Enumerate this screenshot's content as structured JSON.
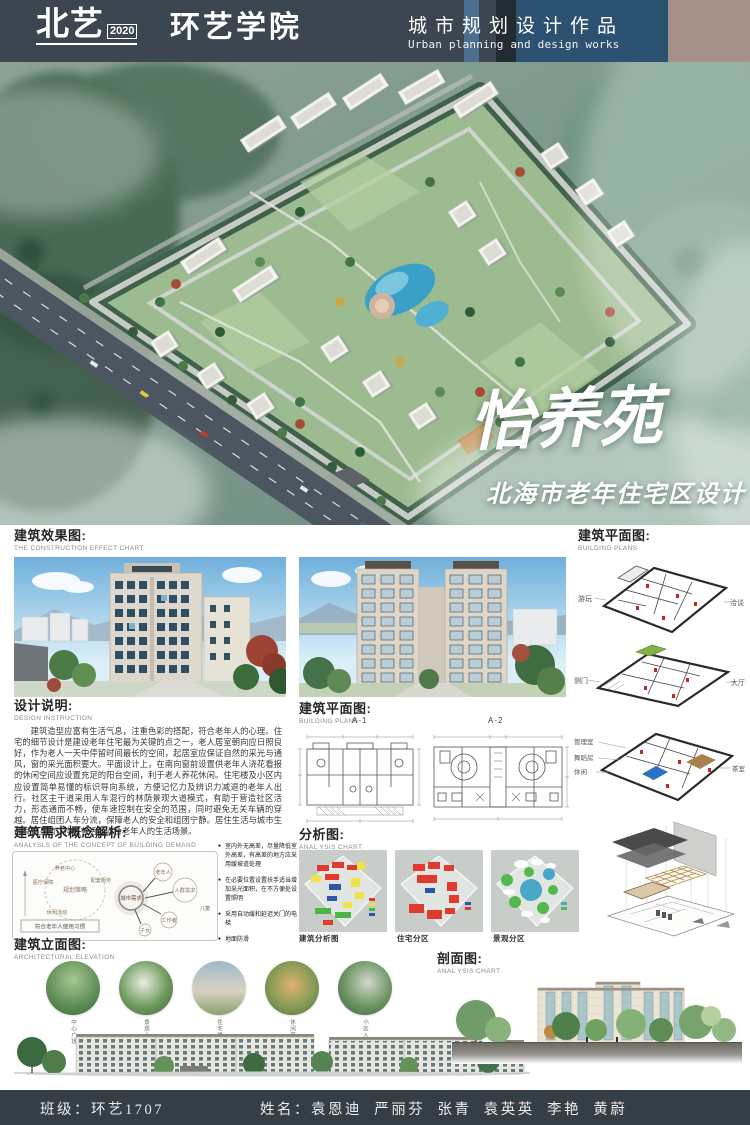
{
  "header": {
    "logo_primary": "北艺",
    "logo_year": "2020",
    "logo_secondary": "环艺学院",
    "work_title_cn": "城市规划设计作品",
    "work_title_en": "Urban planning and design works"
  },
  "hero": {
    "project_title": "怡养苑",
    "project_subtitle": "北海市老年住宅区设计"
  },
  "effect_section": {
    "title": "建筑效果图:",
    "subtitle": "THE CONSTRUCTION EFFECT CHART"
  },
  "plans_right_section": {
    "title": "建筑平面图:",
    "subtitle": "BUILDING PLANS",
    "floor1_label_left": "游玩",
    "floor1_label_right": "洽谈",
    "floor2_label_left": "侧门",
    "floor2_label_right": "大厅",
    "floor3_label_1": "管理室",
    "floor3_label_2": "舞蹈房",
    "floor3_label_3": "休闲",
    "floor3_label_right": "茶室"
  },
  "design_section": {
    "title": "设计说明:",
    "subtitle": "DESIGN INSTRUCTION",
    "body": "建筑造型应富有生活气息，注重色彩的搭配，符合老年人的心理。住宅的细节设计是建设老年住宅最为关键的点之一，老人居室朝向应日照良好，作为老人一天中停留时间最长的空间，起居室应保证自然的采光与通风，窗的采光面积要大。平面设计上，在南向窗前设置供老年人浇花看报的休闲空间应设置充足的阳台空间，利于老人养花休闲。住宅楼及小区内应设置简单易懂的标识导向系统，方便记忆力及辨识力减退的老年人出行。社区主干道采用人车混行的林荫景观大道模式，有助于营造社区活力，形态通而不畅，使车速控制在安全的范围，同时避免无关车辆的穿越。居住组团人车分流，保障老人的安全和组团宁静。居住生活与城市生活良性互动，构成有活力适合老年人的生活场景。"
  },
  "plans_mid_section": {
    "title": "建筑平面图:",
    "subtitle": "BUILDING PLANS",
    "plan_a": "A-1",
    "plan_b": "A-2"
  },
  "demand_section": {
    "title": "建筑需求概念解析:",
    "subtitle": "ANALYSLS OF THE CONCEPT OF BUILDING DEMAND",
    "bubbles": {
      "center": "城市需求",
      "strategy": "规划策略",
      "s1": "养老中心",
      "s2": "配套服务",
      "s3": "医疗保障",
      "s4": "休闲活动",
      "p_main": "人群需求",
      "p1": "老年人",
      "p2": "工作者",
      "p3": "子女",
      "p4": "儿童",
      "note": "符合老年人使用习惯"
    },
    "bullets": [
      "室内外无高差，尽量降低室外高差，有高差的地方应采用缓坡道处理",
      "在必要位置设置扶手适当增加采光面积，在不方便处设置照明",
      "采用自动缓和延迟关门的电梯",
      "地面防滑"
    ]
  },
  "analysis_section": {
    "title": "分析图:",
    "subtitle": "ANAL YSIS CHART",
    "captions": [
      "建筑分析图",
      "住宅分区",
      "景观分区"
    ]
  },
  "elevation_section": {
    "title": "建筑立面图:",
    "subtitle": "ARCHITECTURAL ELEVATION",
    "circle_labels": [
      "中心广场",
      "景观小品",
      "住宅楼",
      "休闲庭院",
      "小区入口"
    ]
  },
  "section_drawing": {
    "title": "剖面图:",
    "subtitle": "ANAL YSIS CHART"
  },
  "footer": {
    "class_label": "班级：环艺1707",
    "names_label": "姓名：袁恩迪  严丽芬  张青  袁英英  李艳  黄蔚"
  },
  "palette": {
    "header_dark": "#3b4650",
    "header_blue": "#2d5170",
    "header_taupe": "#a5908a",
    "footer_dark": "#343e46",
    "analysis_red": "#e03a2e",
    "analysis_yellow": "#efe24a",
    "analysis_blue": "#2b57a8",
    "analysis_green": "#4db548",
    "analysis_teal": "#49a8c8"
  }
}
